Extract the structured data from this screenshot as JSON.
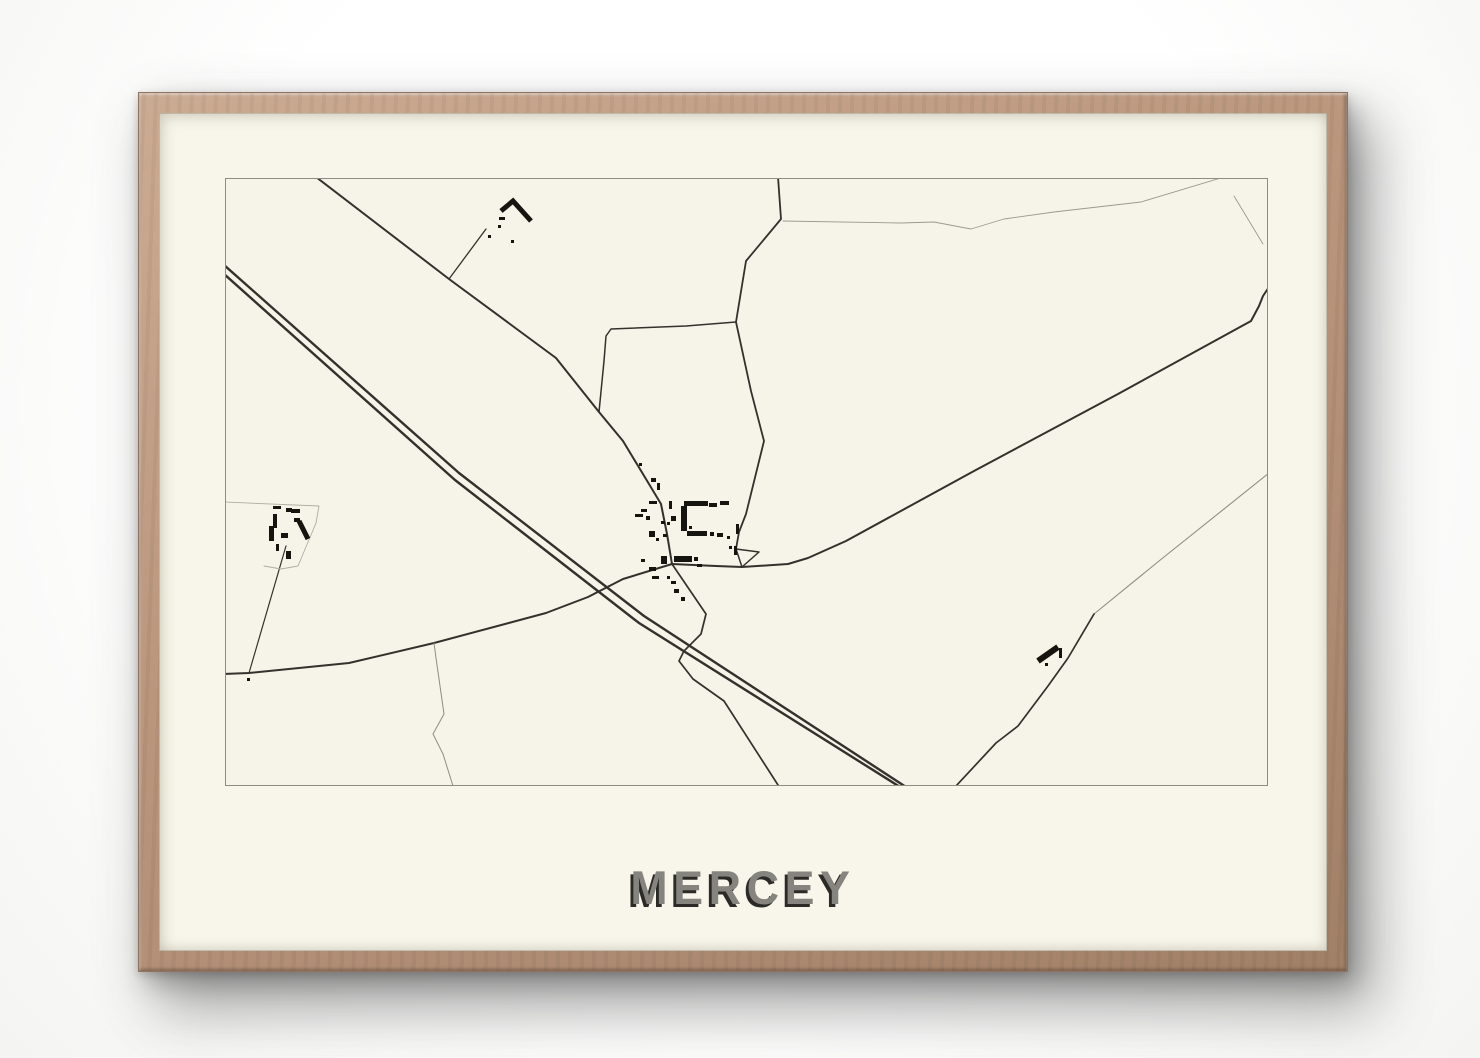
{
  "poster": {
    "title": "MERCEY",
    "colors": {
      "page_bg": "#ffffff",
      "frame_wood": "#b8947b",
      "mat": "#f8f6eb",
      "map_bg": "#f6f4e8",
      "map_border": "#8d8c82",
      "road": "#32312c",
      "faint_line": "#9b9a8f",
      "building": "#15140f",
      "title_fill": "#85847e",
      "title_shadow": "#2b2a26"
    }
  },
  "map": {
    "place": "Mercey",
    "viewbox": "0 0 1041 606",
    "roads": [
      {
        "name": "highway-line-1",
        "d": "M -2,86 L 233,294 L 418,437 L 680,608",
        "w": 2.4
      },
      {
        "name": "highway-line-2",
        "d": "M -2,95 L 229,301 L 413,444 L 674,608",
        "w": 2.4
      },
      {
        "name": "nw-road-main-street",
        "d": "M 90,-2 L 223,100 L 330,179 L 373,233 L 397,262 L 426,310 L 435,325 L 441,355 L 446,385",
        "w": 2
      },
      {
        "name": "farm-track-north",
        "d": "M 223,100 L 260,50",
        "w": 1.3
      },
      {
        "name": "connector-road",
        "d": "M 373,233 L 378,182 L 380,157 L 385,150 L 460,147 L 510,143",
        "w": 1.5
      },
      {
        "name": "north-road",
        "d": "M 552,-2 L 555,40 L 520,82 L 510,143 L 525,212 L 538,262 L 520,335 L 513,353 L 510,370",
        "w": 1.8
      },
      {
        "name": "triangle-junction",
        "d": "M 510,370 L 533,373 L 516,388 Z",
        "w": 1.5
      },
      {
        "name": "east-diagonal-road",
        "d": "M 446,385 L 490,387 L 516,388 L 562,385 L 582,379 L 620,362 L 748,292 L 892,215 L 1025,142 L 1033,127 L 1037,117 L 1043,108",
        "w": 2
      },
      {
        "name": "west-road",
        "d": "M 446,385 L 397,400 L 362,418 L 320,434 L 208,464 L 123,484 L 23,494 L -2,495",
        "w": 2
      },
      {
        "name": "farm-track-west",
        "d": "M 23,494 L 60,367",
        "w": 1.2
      },
      {
        "name": "south-road",
        "d": "M 446,385 L 480,435 L 475,455 L 458,472 L 453,482 L 467,500 L 498,522 L 552,606",
        "w": 1.7
      },
      {
        "name": "stream-south",
        "d": "M 208,464 L 210,479 L 218,535 L 207,555 L 217,575 L 227,607",
        "w": 1,
        "c": "#8f8e84"
      },
      {
        "name": "se-road-upper",
        "d": "M 1043,294 L 933,382 L 868,435",
        "w": 1.1,
        "c": "#8f8e84"
      },
      {
        "name": "se-road-lower",
        "d": "M 868,435 L 842,479 L 822,507 L 792,547 L 770,564 L 730,607",
        "w": 1.7
      },
      {
        "name": "field-line-north",
        "d": "M 557,42 L 675,44 L 708,43 L 745,50 L 778,40 L 828,33 L 915,23 L 998,-2",
        "w": 0.9,
        "c": "#9b9a8f"
      },
      {
        "name": "field-line-ne",
        "d": "M 1008,17 L 1037,65",
        "w": 0.9,
        "c": "#9b9a8f"
      },
      {
        "name": "parcel-boundary-west",
        "d": "M -2,323 L 93,327 L 90,344 L 72,387 L 55,390 L 38,387",
        "w": 0.9,
        "c": "#aeada1"
      }
    ],
    "building_strokes": [
      {
        "name": "building-chevron-north",
        "d": "M 275,32 L 287,22 L 305,42",
        "w": 5
      },
      {
        "name": "building-bar-left",
        "d": "M 73,342 L 82,360",
        "w": 5
      },
      {
        "name": "building-bar-east",
        "d": "M 812,482 L 832,468",
        "w": 6
      }
    ],
    "buildings": [
      [
        273,
        38,
        6,
        3
      ],
      [
        272,
        46,
        3,
        3
      ],
      [
        262,
        56,
        3,
        3
      ],
      [
        285,
        61,
        3,
        3
      ],
      [
        47,
        327,
        8,
        3
      ],
      [
        60,
        329,
        6,
        4
      ],
      [
        65,
        330,
        9,
        4
      ],
      [
        47,
        335,
        4,
        14
      ],
      [
        68,
        339,
        6,
        4
      ],
      [
        43,
        347,
        5,
        15
      ],
      [
        55,
        354,
        7,
        5
      ],
      [
        50,
        365,
        3,
        7
      ],
      [
        60,
        372,
        5,
        8
      ],
      [
        21,
        499,
        3,
        3
      ],
      [
        413,
        284,
        3,
        3
      ],
      [
        425,
        299,
        5,
        4
      ],
      [
        431,
        304,
        3,
        7
      ],
      [
        423,
        322,
        8,
        3
      ],
      [
        443,
        322,
        3,
        8
      ],
      [
        415,
        330,
        6,
        3
      ],
      [
        409,
        335,
        8,
        3
      ],
      [
        420,
        337,
        4,
        4
      ],
      [
        445,
        337,
        5,
        5
      ],
      [
        435,
        342,
        4,
        3
      ],
      [
        441,
        343,
        3,
        3
      ],
      [
        423,
        352,
        6,
        6
      ],
      [
        437,
        355,
        4,
        3
      ],
      [
        430,
        359,
        3,
        3
      ],
      [
        458,
        322,
        24,
        5
      ],
      [
        455,
        327,
        6,
        25
      ],
      [
        483,
        324,
        8,
        4
      ],
      [
        494,
        322,
        9,
        4
      ],
      [
        463,
        347,
        3,
        3
      ],
      [
        461,
        352,
        20,
        5
      ],
      [
        484,
        353,
        4,
        4
      ],
      [
        491,
        354,
        6,
        4
      ],
      [
        501,
        357,
        3,
        3
      ],
      [
        510,
        345,
        3,
        10
      ],
      [
        508,
        367,
        3,
        9
      ],
      [
        503,
        367,
        3,
        3
      ],
      [
        448,
        377,
        18,
        6
      ],
      [
        468,
        378,
        4,
        4
      ],
      [
        471,
        385,
        5,
        3
      ],
      [
        435,
        377,
        6,
        8
      ],
      [
        423,
        388,
        7,
        4
      ],
      [
        415,
        380,
        4,
        3
      ],
      [
        426,
        397,
        7,
        3
      ],
      [
        441,
        397,
        3,
        3
      ],
      [
        445,
        402,
        5,
        3
      ],
      [
        448,
        410,
        5,
        4
      ],
      [
        455,
        418,
        4,
        4
      ],
      [
        833,
        469,
        3,
        10
      ],
      [
        819,
        484,
        3,
        3
      ]
    ]
  }
}
